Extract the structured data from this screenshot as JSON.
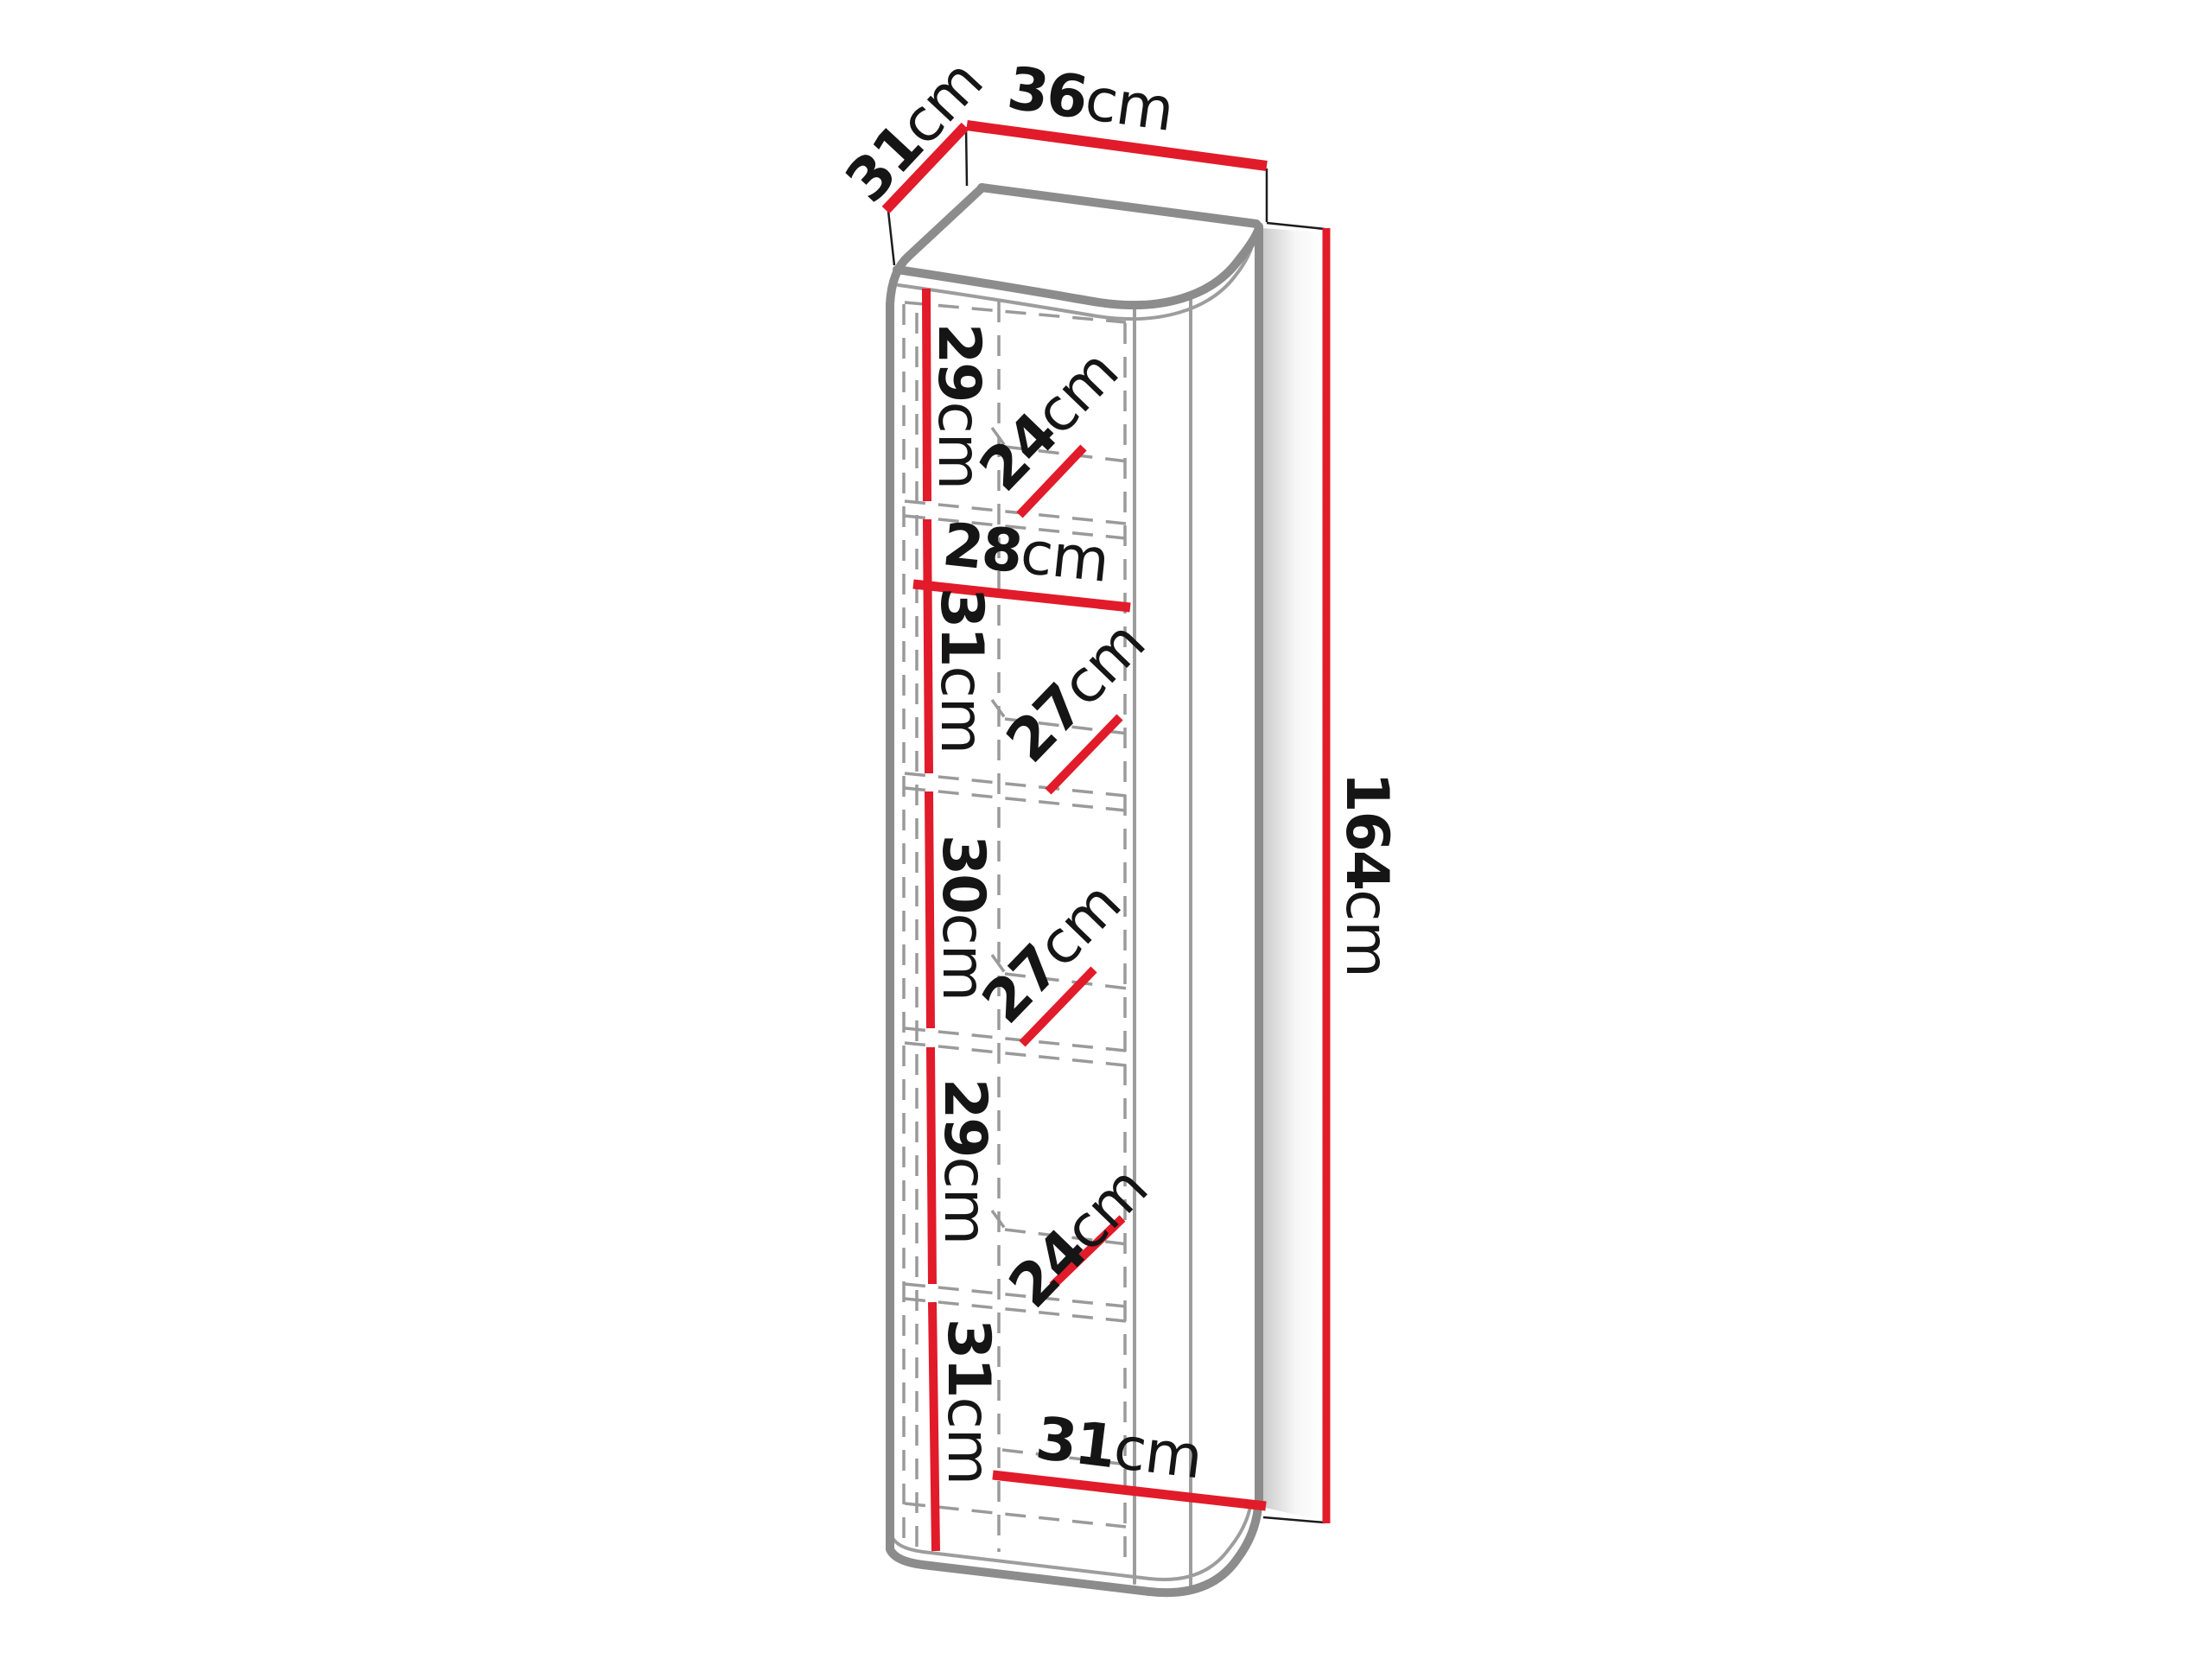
{
  "figure": {
    "type": "furniture-dimension-diagram",
    "subject": "tall cabinet with five interior compartments"
  },
  "colors": {
    "dimension_line": "#e11b2a",
    "cabinet_edge": "#8c8c8c",
    "cabinet_edge_light": "#9d9d9d",
    "hidden_line": "#9a9a9a",
    "extension_line": "#1c1c1c",
    "label_text": "#151515",
    "background": "#ffffff"
  },
  "dimensions": {
    "depth_top": {
      "value": "31",
      "unit": "cm"
    },
    "width_top": {
      "value": "36",
      "unit": "cm"
    },
    "height_right": {
      "value": "164",
      "unit": "cm"
    },
    "inner_width_top": {
      "value": "28",
      "unit": "cm"
    },
    "inner_width_bottom": {
      "value": "31",
      "unit": "cm"
    },
    "sections": [
      {
        "height_value": "29",
        "height_unit": "cm",
        "depth_value": "24",
        "depth_unit": "cm"
      },
      {
        "height_value": "31",
        "height_unit": "cm",
        "depth_value": "27",
        "depth_unit": "cm"
      },
      {
        "height_value": "30",
        "height_unit": "cm",
        "depth_value": "27",
        "depth_unit": "cm"
      },
      {
        "height_value": "29",
        "height_unit": "cm",
        "depth_value": "24",
        "depth_unit": "cm"
      },
      {
        "height_value": "31",
        "height_unit": "cm"
      }
    ]
  }
}
